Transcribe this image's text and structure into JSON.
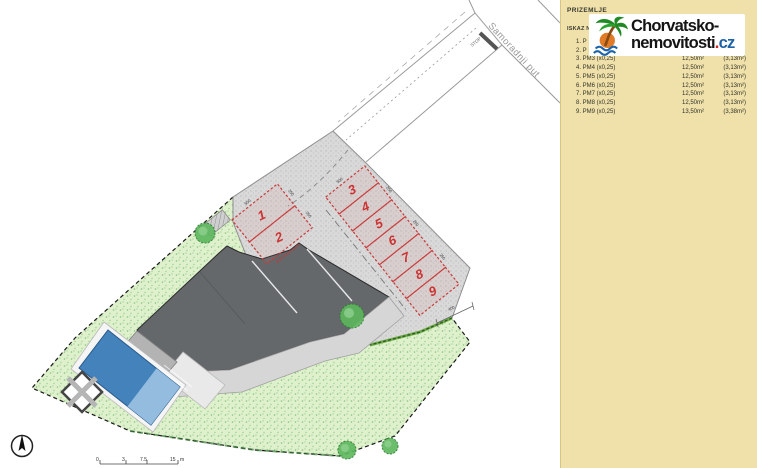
{
  "panel": {
    "title": "PRIZEMLJE",
    "subtitle": "ISKAZ NE",
    "rows": [
      {
        "label": "1. P",
        "area": "",
        "coef": ""
      },
      {
        "label": "2. P",
        "area": "",
        "coef": ""
      },
      {
        "label": "3. PM3 (x0,25)",
        "area": "12,50m²",
        "coef": "(3,13m²)"
      },
      {
        "label": "4. PM4 (x0,25)",
        "area": "12,50m²",
        "coef": "(3,13m²)"
      },
      {
        "label": "5. PM5 (x0,25)",
        "area": "12,50m²",
        "coef": "(3,13m²)"
      },
      {
        "label": "6. PM6 (x0,25)",
        "area": "12,50m²",
        "coef": "(3,13m²)"
      },
      {
        "label": "7. PM7 (x0,25)",
        "area": "12,50m²",
        "coef": "(3,13m²)"
      },
      {
        "label": "8. PM8 (x0,25)",
        "area": "12,50m²",
        "coef": "(3,13m²)"
      },
      {
        "label": "9. PM9 (x0,25)",
        "area": "13,50m²",
        "coef": "(3,38m²)"
      }
    ],
    "bg_color": "#efe1a9"
  },
  "logo": {
    "line1": "Chorvatsko-",
    "line2": "nemovitosti",
    "dot": ".",
    "tld": "cz",
    "dot_color": "#cf241c",
    "tld_color": "#1c63a8",
    "icon": "palm-tree-icon"
  },
  "plan": {
    "road_label": "Samoradnji put",
    "stop_label": "STOP",
    "charger_label": "ELEKTROPUNJAČ",
    "spaces": [
      "1",
      "2",
      "3",
      "4",
      "5",
      "6",
      "7",
      "8",
      "9"
    ],
    "dims": {
      "d500": "500",
      "d250": "250",
      "d400": "400"
    },
    "scalebar": {
      "t0": "0",
      "t1": "3",
      "t2": "7.5",
      "t3": "15",
      "unit": "m"
    },
    "colors": {
      "pavement": "#d9d9d9",
      "lawn": "#dff0cc",
      "building": "#65686b",
      "terrace": "#d6d6d6",
      "pool": "#4382bb",
      "pool_shallow": "#93bcdf",
      "space_outline": "#c93a3a",
      "hedge": "#66a83c"
    }
  }
}
